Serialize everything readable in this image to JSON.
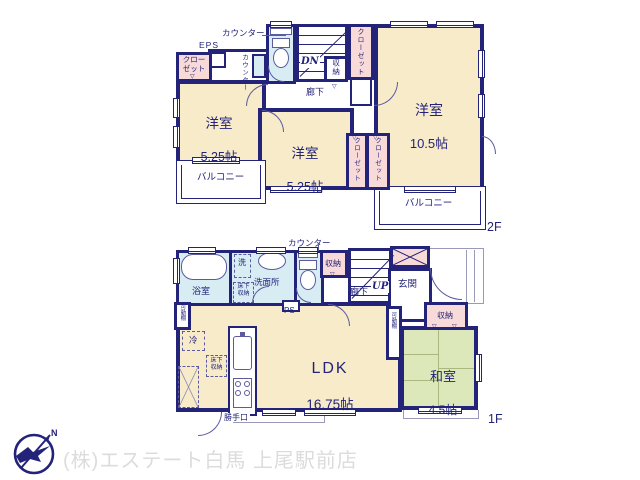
{
  "colors": {
    "wall": "#23237a",
    "room": "#f8ebc9",
    "closet": "#f8dbd8",
    "wet": "#d8ecf4",
    "tatami": "#dce8ba",
    "line": "#5b5b9e",
    "porch": "#9a9ab8",
    "tatami_line": "#aab87f",
    "footer_text": "#dcdcdc",
    "logo": "#23237a"
  },
  "icons": {
    "swing_marker": "▽"
  },
  "floor2": {
    "floor_label": "2F",
    "counter_top": "カウンター",
    "eps": "EPS",
    "closet_topleft": "クロー\nゼット",
    "counter_side": "カウンター",
    "stairs_dn": "DN",
    "storage": "収納",
    "closet_stairs": "クローゼット",
    "hallway": "廊下",
    "rooms": {
      "west": {
        "name": "洋室",
        "size": "5.25帖"
      },
      "center": {
        "name": "洋室",
        "size": "5.25帖"
      },
      "east": {
        "name": "洋室",
        "size": "10.5帖"
      }
    },
    "closet_center_1": "クローゼット",
    "closet_center_2": "クローゼット",
    "balcony_west": "バルコニー",
    "balcony_east": "バルコニー"
  },
  "floor1": {
    "floor_label": "1F",
    "counter_top": "カウンター",
    "bath": "浴室",
    "washer": "洗",
    "underfloor_wet": "床下\n収納",
    "washroom": "洗面所",
    "storage_hall": "収納",
    "stairs_up": "UP",
    "hallway": "廊下",
    "entrance": "玄関",
    "ps": "PS",
    "shelf_west": "可動棚",
    "fridge": "冷",
    "underfloor_ldk": "床下\n収納",
    "ldk": {
      "name": "LDK",
      "size": "16.75帖"
    },
    "back_door": "勝手口",
    "shelf_east": "可動棚",
    "storage_tatami": "収納",
    "tatami_room": {
      "name": "和室",
      "size": "4.5帖"
    }
  },
  "footer": {
    "company": "(株)エステート白馬 上尾駅前店",
    "compass_n": "N"
  }
}
